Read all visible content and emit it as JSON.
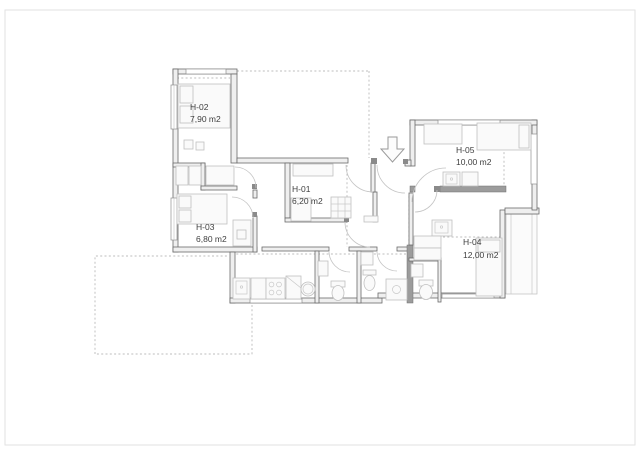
{
  "plan": {
    "background": "#ffffff",
    "rooms": [
      {
        "id": "H-01",
        "area": "6,20 m2"
      },
      {
        "id": "H-02",
        "area": "7,90 m2"
      },
      {
        "id": "H-03",
        "area": "6,80 m2"
      },
      {
        "id": "H-04",
        "area": "12,00 m2"
      },
      {
        "id": "H-05",
        "area": "10,00 m2"
      }
    ],
    "icons": {
      "entrance_arrow": "down-arrow-entrance",
      "fixtures": [
        "bed-icon",
        "wardrobe-icon",
        "desk-icon",
        "sink-icon",
        "toilet-icon",
        "shower-icon",
        "stove-icon",
        "kitchen-sink-icon",
        "washing-machine-icon",
        "fridge-icon"
      ]
    },
    "colors": {
      "wall_stroke": "#6a6a6a",
      "wall_fill": "#efefef",
      "dark_bar": "#9c9c9c",
      "furniture": "#c0c0c0",
      "dashed_outline": "#a8a8a8",
      "label_text": "#3e3e3e"
    }
  }
}
